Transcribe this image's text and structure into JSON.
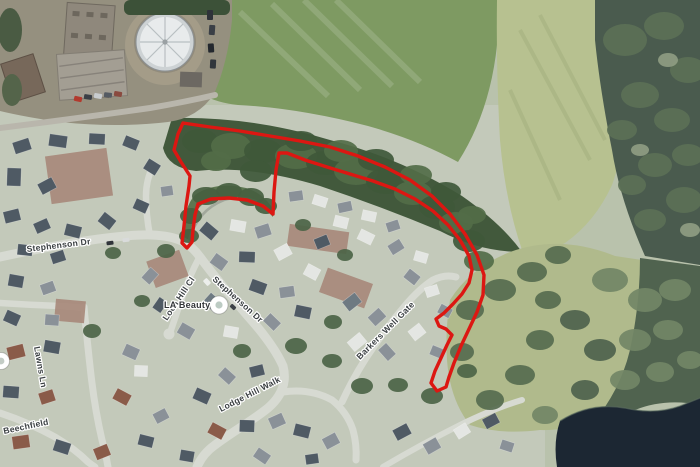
{
  "map": {
    "view": "satellite",
    "street_labels": [
      {
        "id": "stephenson-dr-west",
        "text": "Stephenson Dr"
      },
      {
        "id": "stephenson-dr-south",
        "text": "Stephenson Dr"
      },
      {
        "id": "loch-hill-cl",
        "text": "Loch Hill Cl"
      },
      {
        "id": "lawns-ln",
        "text": "Lawns Ln"
      },
      {
        "id": "beechfield",
        "text": "Beechfield"
      },
      {
        "id": "lodge-hill-walk",
        "text": "Lodge Hill Walk"
      },
      {
        "id": "barkers-well-gate",
        "text": "Barkers Well Gate"
      }
    ],
    "poi": {
      "label": "LA Beauty"
    },
    "overlay": {
      "boundary_color": "#dc1712"
    }
  }
}
